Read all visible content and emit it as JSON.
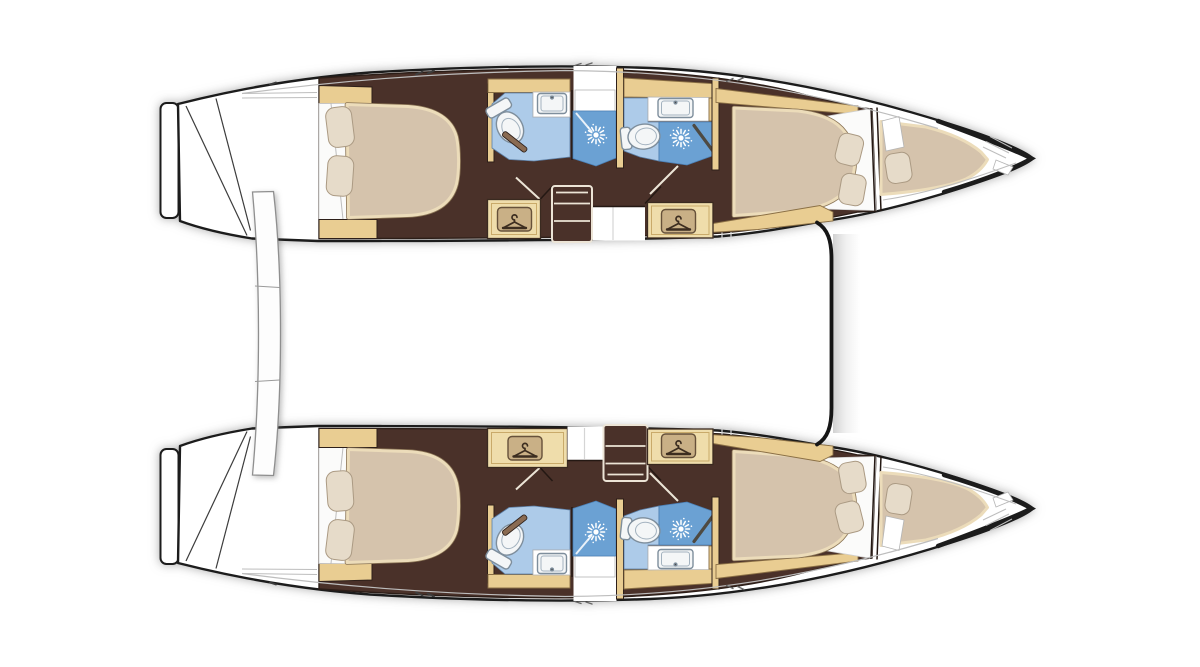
{
  "meta": {
    "title": "Catamaran interior layout plan - twin hulls, top view",
    "type": "boat-floor-plan",
    "orientation": {
      "bow": "right",
      "stern": "left"
    }
  },
  "background": "#ffffff",
  "colors": {
    "background": "#ffffff",
    "hull_outline": "#1c1c1c",
    "line_gray": "#bdbdbd",
    "deck_white": "#ffffff",
    "floor_brown": "#4a3129",
    "cabinet_tan": "#e9cd92",
    "wardrobe_tan": "#efddab",
    "bed_tan": "#d5c3ac",
    "bed_trim": "#ecdcba",
    "sheet_white": "#fbfbfa",
    "pillow_cream": "#e6dbc9",
    "head_blue": "#adcbe9",
    "shower_blue": "#6ba1d3",
    "fixture_white": "#f4f6f7",
    "fixture_stroke": "#7e8e9c",
    "sun_white": "#ffffff",
    "badge_fill": "#c9b086",
    "badge_border": "#66513a",
    "glyph_brown": "#3c2d20",
    "steps_outline": "#ece4d6",
    "door_wood": "#8a6b52"
  },
  "structure": {
    "hull_count": 2,
    "cabins": 4,
    "heads": 4,
    "showers": 4,
    "berths": 6,
    "center_elements": [
      "aft-crossbeam",
      "forward-bridgedeck-edge"
    ]
  },
  "hulls": [
    {
      "name": "port-hull",
      "position": "top",
      "rooms": [
        {
          "name": "transom-steps"
        },
        {
          "name": "aft-cabin",
          "furniture": [
            "island-double-berth",
            "2-pillows",
            "headboard",
            "cabinets",
            "wardrobe-with-hanger"
          ]
        },
        {
          "name": "aft-head",
          "fixtures": [
            "toilet",
            "sink",
            "shower-with-spray"
          ]
        },
        {
          "name": "companionway-steps",
          "treads": 3
        },
        {
          "name": "forward-head",
          "fixtures": [
            "toilet",
            "sink",
            "shower-with-spray"
          ]
        },
        {
          "name": "forward-cabin",
          "furniture": [
            "double-berth",
            "2-pillows",
            "wardrobe-with-hanger"
          ]
        },
        {
          "name": "forepeak",
          "furniture": [
            "single-berth",
            "1-pillow"
          ]
        }
      ]
    },
    {
      "name": "starboard-hull",
      "position": "bottom",
      "rooms": [
        {
          "name": "transom-steps"
        },
        {
          "name": "aft-cabin",
          "furniture": [
            "island-double-berth",
            "2-pillows",
            "headboard",
            "cabinets",
            "wardrobe-with-hanger"
          ]
        },
        {
          "name": "aft-head",
          "fixtures": [
            "toilet",
            "sink",
            "shower-with-spray"
          ]
        },
        {
          "name": "companionway-steps",
          "treads": 3
        },
        {
          "name": "forward-head",
          "fixtures": [
            "toilet",
            "sink",
            "shower-with-spray"
          ]
        },
        {
          "name": "forward-cabin",
          "furniture": [
            "double-berth",
            "2-pillows",
            "wardrobe-with-hanger"
          ]
        },
        {
          "name": "forepeak",
          "furniture": [
            "single-berth",
            "1-pillow"
          ]
        }
      ]
    }
  ],
  "icons": [
    "hanger-icon",
    "shower-spray-icon",
    "toilet-icon",
    "sink-icon"
  ]
}
